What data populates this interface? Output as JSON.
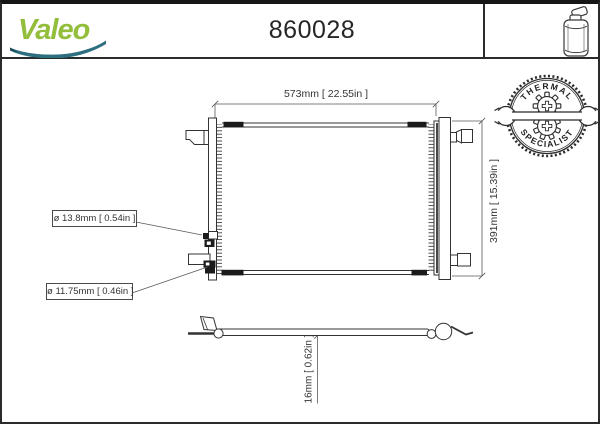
{
  "header": {
    "brand": "Valeo",
    "part_number": "860028"
  },
  "stamp": {
    "top_text": "THERMAL",
    "bottom_text": "SPECIALIST"
  },
  "front_view": {
    "width_label": "573mm [ 22.55in ]",
    "height_label": "391mm [ 15.39in ]",
    "port_top_diameter_label": "ø 13.8mm [ 0.54in ]",
    "port_bottom_diameter_label": "ø 11.75mm [ 0.46in ]"
  },
  "side_view": {
    "thickness_label": "16mm [ 0.62in ]"
  },
  "icons": {
    "top_right": "receiver-drier-bottle-icon",
    "stamp_center": "wrench-and-gear-icon"
  },
  "colors": {
    "brand_green": "#93BE3C",
    "brand_teal": "#2E6F7F",
    "ink": "#2b2b2b",
    "dim_line": "#5a5a5a"
  }
}
